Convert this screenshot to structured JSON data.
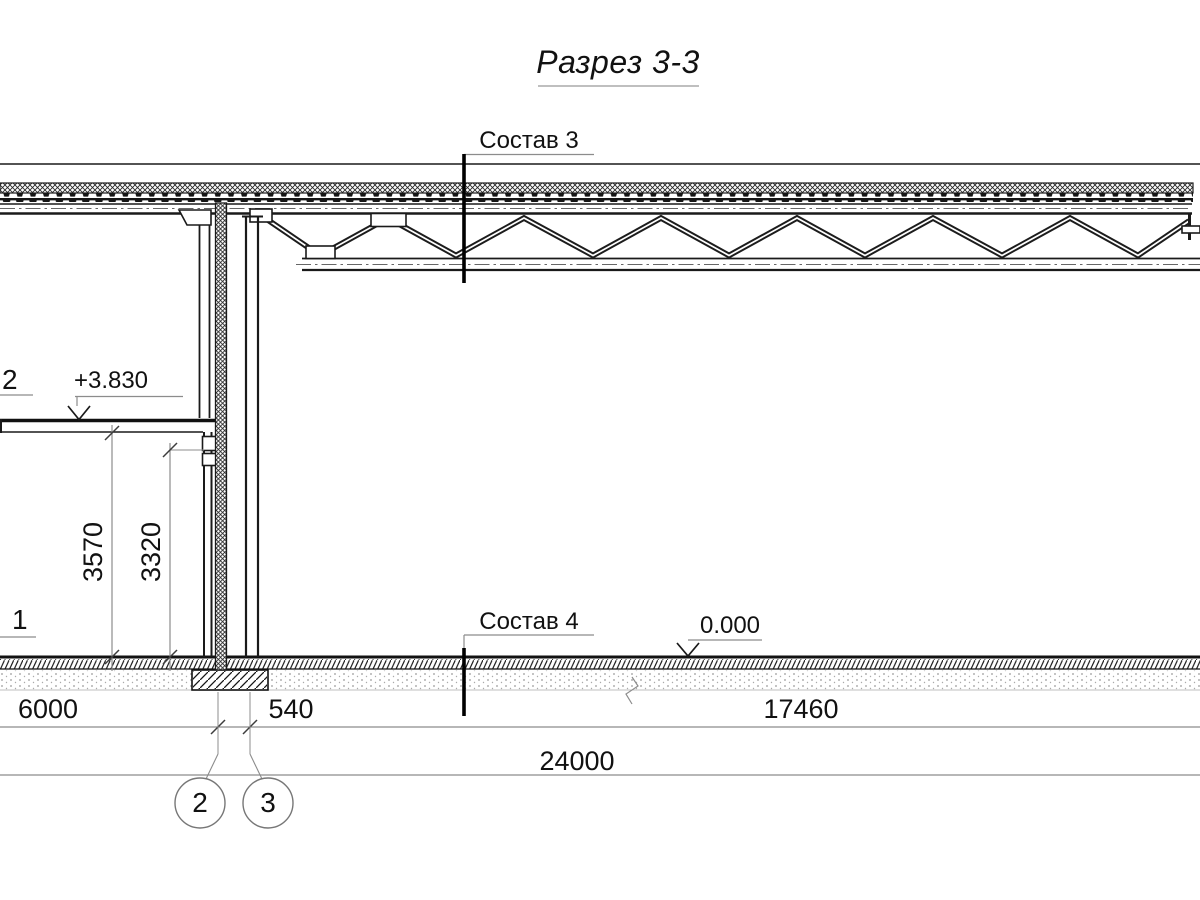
{
  "drawing": {
    "title": "Разрез 3-3",
    "markers": {
      "roof": "Состав 3",
      "floor": "Состав 4"
    },
    "elevations": {
      "second_floor": "+3.830",
      "ground": "0.000"
    },
    "dimensions": {
      "vertical": {
        "v1": "3570",
        "v2": "3320"
      },
      "horizontal": {
        "h1": "6000",
        "h2": "540",
        "h3": "17460",
        "total": "24000"
      }
    },
    "grid": {
      "axis_left": "2",
      "axis_right": "3"
    },
    "callouts": {
      "upper": "2",
      "lower": "1"
    }
  }
}
